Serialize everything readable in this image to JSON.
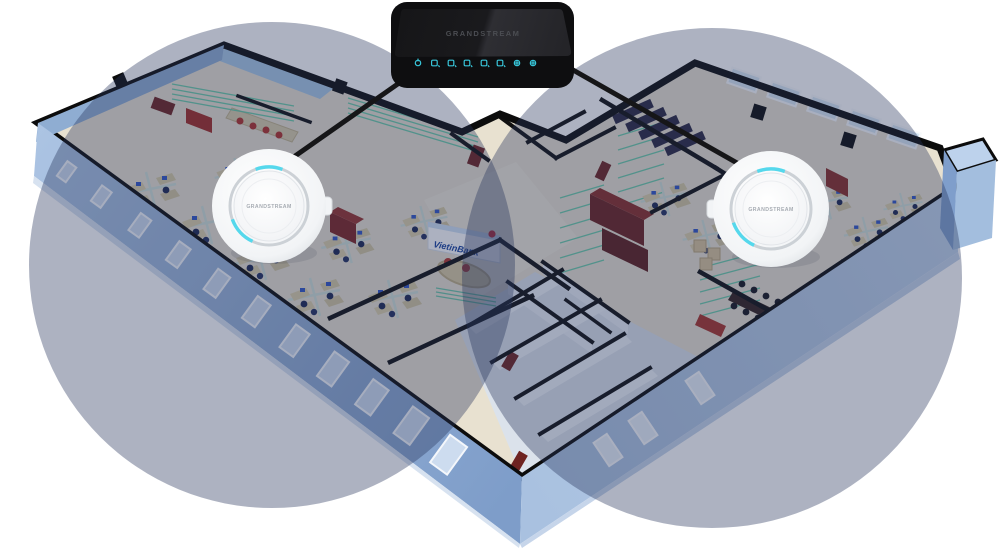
{
  "figure": {
    "type": "wifi-coverage-diagram",
    "background": "#ffffff",
    "router": {
      "brand_label": "GRANDSTREAM",
      "body_color": "#0e0e10",
      "led_color": "#38c6da",
      "led_count": 8
    },
    "access_points": [
      {
        "id": "ap-left",
        "brand_label": "GRANDSTREAM",
        "led_color": "#55d8ec",
        "body_color": "#ffffff"
      },
      {
        "id": "ap-right",
        "brand_label": "GRANDSTREAM",
        "led_color": "#55d8ec",
        "body_color": "#ffffff"
      }
    ],
    "coverage_circles": [
      {
        "side": "left",
        "cx": 272,
        "cy": 265,
        "r": 243,
        "color": "#28345c",
        "opacity": 0.38
      },
      {
        "side": "right",
        "cx": 712,
        "cy": 278,
        "r": 250,
        "color": "#28345c",
        "opacity": 0.38
      }
    ],
    "cables": {
      "color": "#161618"
    },
    "floorplan": {
      "sign_label": "VietinBank",
      "sign_text_color": "#17429e",
      "exterior_wall_near": "#7e9dc9",
      "exterior_wall_far": "#a9c2e2",
      "exterior_wall_right": "#b7cde8",
      "floor_color": "#e8e1d0",
      "restroom_zone_color": "#dbe2eb",
      "wall_top_color": "#0c0c0c",
      "partition_glass_stripe": "#5fc9a4",
      "desk_color": "#dbcfa8",
      "chair_color": "#1c2752",
      "accent_red": "#a83228",
      "rack_dark": "#2a2742",
      "rack_maroon": "#6b211d"
    }
  }
}
